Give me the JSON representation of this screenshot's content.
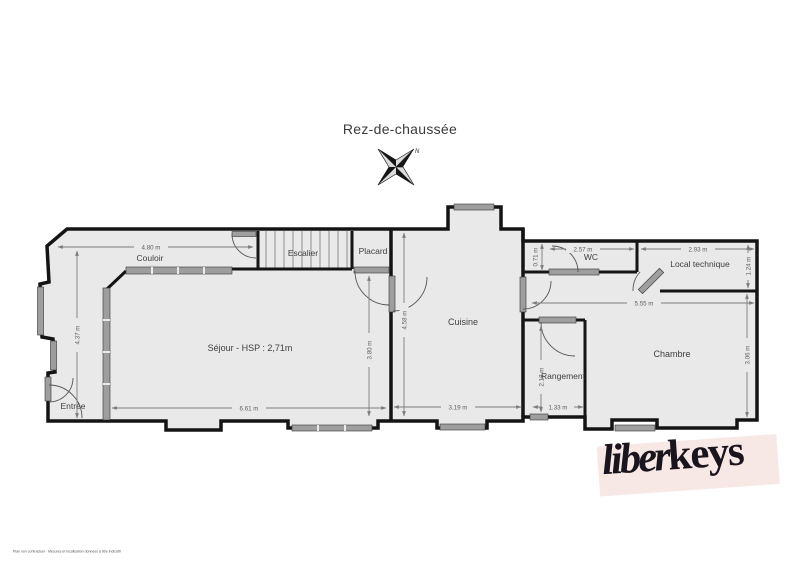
{
  "title": "Rez-de-chaussée",
  "compass": {
    "north_label": "N"
  },
  "rooms": {
    "couloir": {
      "label": "Couloir"
    },
    "escalier": {
      "label": "Escalier"
    },
    "placard": {
      "label": "Placard"
    },
    "sejour": {
      "label": "Séjour - HSP : 2,71m"
    },
    "cuisine": {
      "label": "Cuisine"
    },
    "wc": {
      "label": "WC"
    },
    "local_technique": {
      "label": "Local technique"
    },
    "chambre": {
      "label": "Chambre"
    },
    "rangement": {
      "label": "Rangement"
    },
    "entree": {
      "label": "Entrée"
    }
  },
  "dimensions": {
    "couloir_width": "4.80 m",
    "entree_height": "4.37 m",
    "sejour_width": "6.61 m",
    "sejour_height": "3.80 m",
    "cuisine_height": "4.58 m",
    "cuisine_width": "3.19 m",
    "wc_height": "0.71 m",
    "wc_width": "2.57 m",
    "local_technique_width": "2.93 m",
    "local_technique_height": "1.24 m",
    "right_wing_width": "5.55 m",
    "chambre_height": "3.06 m",
    "rangement_height": "2.18 m",
    "rangement_width": "1.33 m"
  },
  "logo": {
    "script_part": "liber",
    "bold_part": "keys"
  },
  "footer": {
    "disclaimer": "Plan non contractuel - Mesures et localisation données à titre indicatif"
  },
  "colors": {
    "wall": "#141414",
    "room_fill": "#e9e9e9",
    "window": "#9e9e9e",
    "dimension": "#7d7d7d",
    "logo_background": "#f8e8e5",
    "logo_text": "#19141d"
  }
}
